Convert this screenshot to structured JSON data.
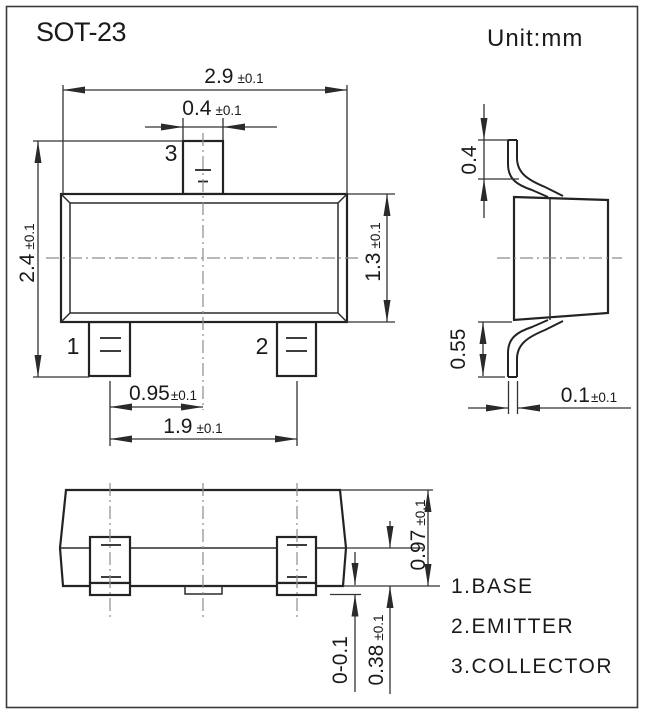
{
  "title": "SOT-23",
  "unit_label": "Unit:mm",
  "pins": {
    "p1": "1",
    "p2": "2",
    "p3": "3"
  },
  "dims": {
    "body_width": {
      "value": "2.9",
      "tol": "±0.1"
    },
    "lead3_width": {
      "value": "0.4",
      "tol": "±0.1"
    },
    "overall_width": {
      "value": "2.4",
      "tol": "±0.1"
    },
    "body_depth": {
      "value": "1.3",
      "tol": "±0.1"
    },
    "lead_pitch": {
      "value": "0.95",
      "tol": "±0.1"
    },
    "lead_span": {
      "value": "1.9",
      "tol": "±0.1"
    },
    "lead_top_height": {
      "value": "0.4",
      "tol": ""
    },
    "lead_bottom_height": {
      "value": "0.55",
      "tol": ""
    },
    "lead_thickness": {
      "value": "0.1",
      "tol": "±0.1"
    },
    "body_height": {
      "value": "0.97",
      "tol": "±0.1"
    },
    "base_height": {
      "value": "0.38",
      "tol": "±0.1"
    },
    "standoff": {
      "value": "0-0.1",
      "tol": ""
    }
  },
  "legend": {
    "items": [
      "1.BASE",
      "2.EMITTER",
      "3.COLLECTOR"
    ]
  },
  "colors": {
    "line": "#232323",
    "centerline": "#8c8c8c",
    "text": "#1a1a1a",
    "background": "#ffffff"
  }
}
